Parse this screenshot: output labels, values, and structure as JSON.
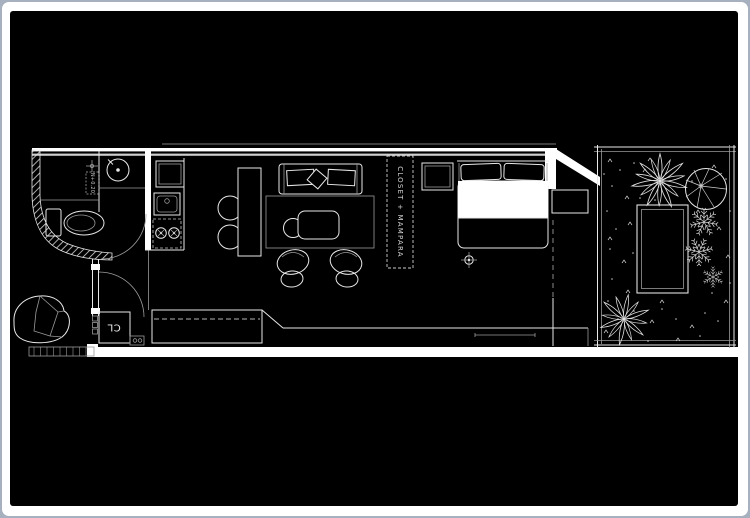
{
  "plan": {
    "labels": {
      "closet_mampara": "CLOSET + MAMPARA",
      "hall_closet": "CL",
      "shower_level": "N+0.20"
    },
    "colors": {
      "background": "#000000",
      "paper_frame": "#ffffff",
      "outer_border": "#a7b0bf",
      "line": "#e8e8e8",
      "dim_line": "#9a9a9a"
    }
  }
}
